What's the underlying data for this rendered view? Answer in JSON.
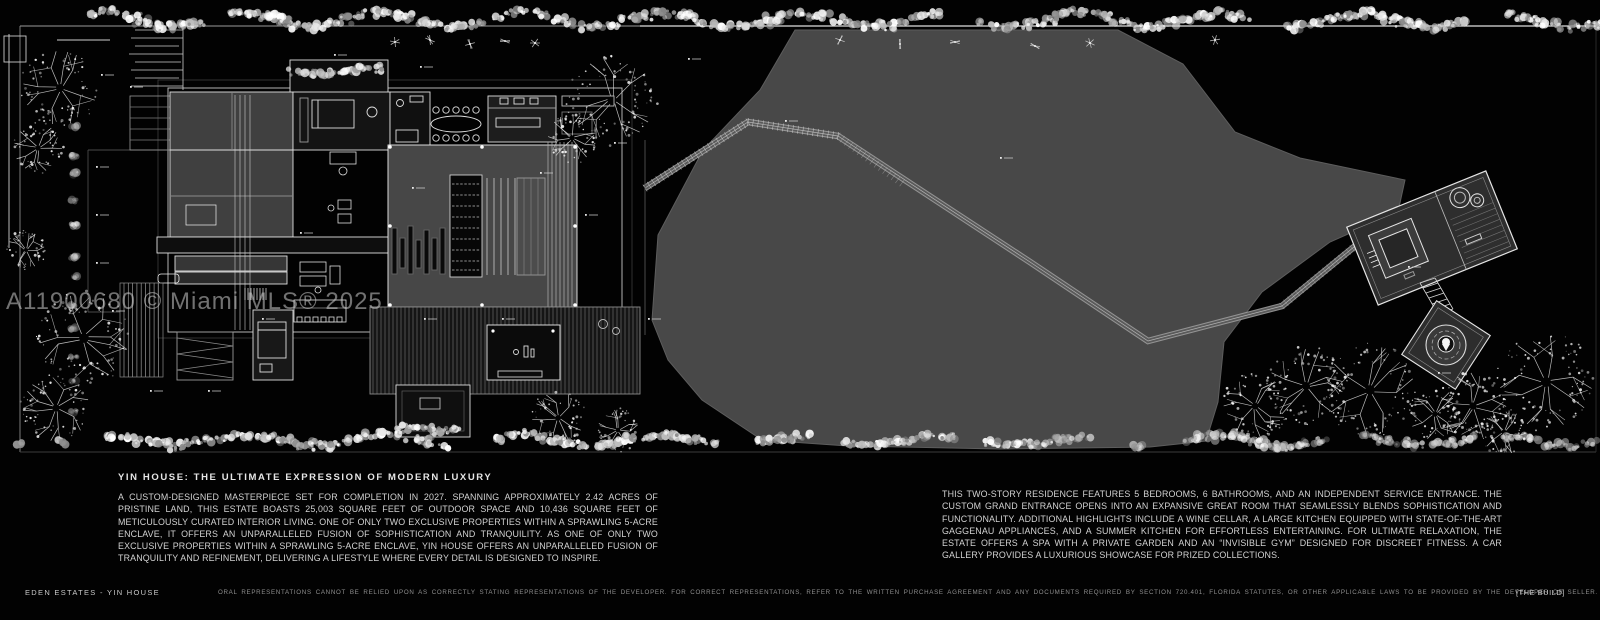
{
  "board": {
    "watermark": "A11900680 © Miami MLS® 2025",
    "title": "YIN HOUSE: THE ULTIMATE EXPRESSION OF MODERN LUXURY",
    "description_left": "A CUSTOM-DESIGNED MASTERPIECE SET FOR COMPLETION IN 2027. SPANNING APPROXIMATELY 2.42 ACRES OF PRISTINE LAND, THIS ESTATE BOASTS 25,003 SQUARE FEET OF OUTDOOR SPACE AND 10,436 SQUARE FEET OF METICULOUSLY CURATED INTERIOR LIVING. ONE OF ONLY TWO EXCLUSIVE PROPERTIES WITHIN A SPRAWLING 5-ACRE ENCLAVE, IT OFFERS AN UNPARALLELED FUSION OF SOPHISTICATION AND TRANQUILITY. AS ONE OF ONLY TWO EXCLUSIVE PROPERTIES WITHIN A SPRAWLING 5-ACRE ENCLAVE, YIN HOUSE OFFERS AN UNPARALLELED FUSION OF TRANQUILITY AND REFINEMENT, DELIVERING A LIFESTYLE WHERE EVERY DETAIL IS DESIGNED TO INSPIRE.",
    "description_right": "THIS TWO-STORY RESIDENCE FEATURES 5 BEDROOMS, 6 BATHROOMS, AND AN INDEPENDENT SERVICE ENTRANCE. THE CUSTOM GRAND ENTRANCE OPENS INTO AN EXPANSIVE GREAT ROOM THAT SEAMLESSLY BLENDS SOPHISTICATION AND FUNCTIONALITY. ADDITIONAL HIGHLIGHTS INCLUDE A WINE CELLAR, A LARGE KITCHEN EQUIPPED WITH STATE-OF-THE-ART GAGGENAU APPLIANCES, AND A SUMMER KITCHEN FOR EFFORTLESS ENTERTAINING. FOR ULTIMATE RELAXATION, THE ESTATE OFFERS A SPA WITH A PRIVATE GARDEN AND AN “INVISIBLE GYM” DESIGNED FOR DISCREET FITNESS. A CAR GALLERY PROVIDES A LUXURIOUS SHOWCASE FOR PRIZED COLLECTIONS."
  },
  "footer": {
    "project": "EDEN ESTATES - YIN HOUSE",
    "disclaimer": "ORAL REPRESENTATIONS CANNOT BE RELIED UPON AS CORRECTLY STATING REPRESENTATIONS OF THE DEVELOPER. FOR CORRECT REPRESENTATIONS, REFER TO THE WRITTEN PURCHASE AGREEMENT AND ANY DOCUMENTS REQUIRED BY SECTION 720.401, FLORIDA STATUTES, OR OTHER APPLICABLE LAWS TO BE PROVIDED BY THE DEVELOPER OR SELLER.",
    "brand": "[THE BUILD]"
  },
  "colors": {
    "background": "#020202",
    "land_parcel": "#4a4a4a",
    "linework": "#e4e4e4",
    "body_text": "#d2d2d2",
    "muted_text": "#8f8f8f"
  }
}
